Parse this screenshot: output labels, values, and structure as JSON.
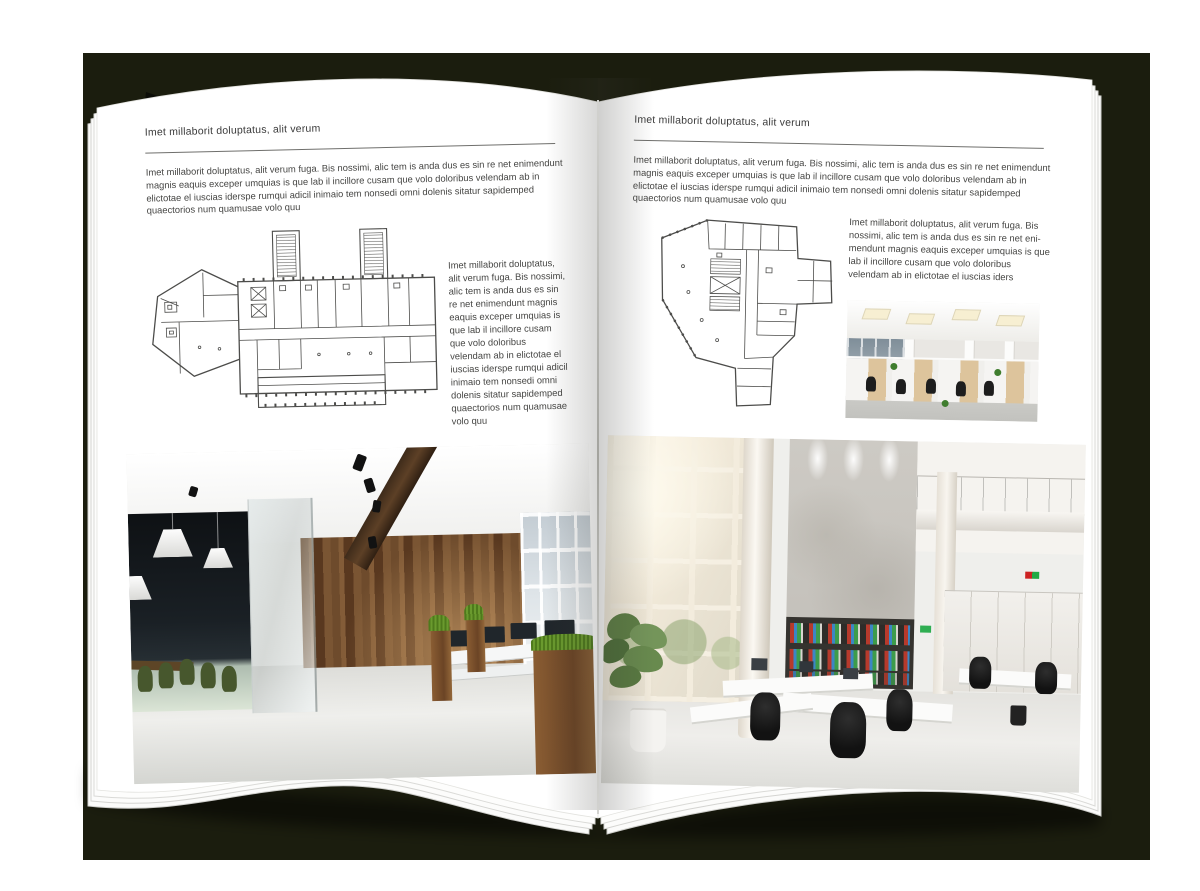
{
  "colors": {
    "backdrop": "#1b1d0e",
    "page": "#ffffff",
    "text": "#464644"
  },
  "left_page": {
    "header": "Imet millaborit doluptatus, alit verum",
    "intro": "Imet millaborit doluptatus, alit verum fuga. Bis nossimi, alic tem is anda dus es sin re net enimendunt magnis eaquis exceper umquias is que lab il incillore cusam que volo doloribus velendam ab in elictotae el iuscias iderspe rumqui adicil inimaio tem nonsedi omni dolenis sitatur sapidemped quaectorios num quamusae volo quu",
    "floor_plan_alt": "Line drawing of a wide building floor plan with two hatched stair towers and an angled left wing",
    "side_text": "Imet millaborit doluptatus, alit verum fuga. Bis nossimi, alic tem is anda dus es sin re net enimendunt magnis eaquis exceper umquias is que lab il incillore cusam que volo doloribus velendam ab in elictotae el iuscias iderspe rumqui adicil inimaio tem nonsedi omni dolenis sitatur sapidemped quaectorios num quamusae volo quu",
    "photo_alt": "Office interior photo: dark glass meeting room with green chairs, wood feature wall, planters and workstations by the windows"
  },
  "right_page": {
    "header": "Imet millaborit doluptatus, alit verum",
    "intro": "Imet millaborit doluptatus, alit verum fuga. Bis nossimi, alic tem is anda dus es sin re net enimendunt magnis eaquis exceper umquias is que lab il incillore cusam que volo doloribus velendam ab in elictotae el iuscias iderspe rumqui adicil inimaio tem nonsedi omni dolenis sitatur sapidemped quaectorios num quamusae volo quu",
    "floor_plan_alt": "Line drawing of an irregular tower floor plan with central hatched service core",
    "side_text": "Imet millaborit doluptatus, alit verum fuga. Bis nossimi, alic tem is anda dus es sin re net eni-mendunt magnis eaquis exceper umquias is que lab il incillore cusam que volo doloribus velendam ab in elictotae el iuscias iders",
    "small_photo_alt": "Open-plan office photo with rows of light-wood workstations and black chairs",
    "photo_alt": "Double-height office atrium photo with glazed facade, concrete wall, binder shelves and white desks"
  }
}
